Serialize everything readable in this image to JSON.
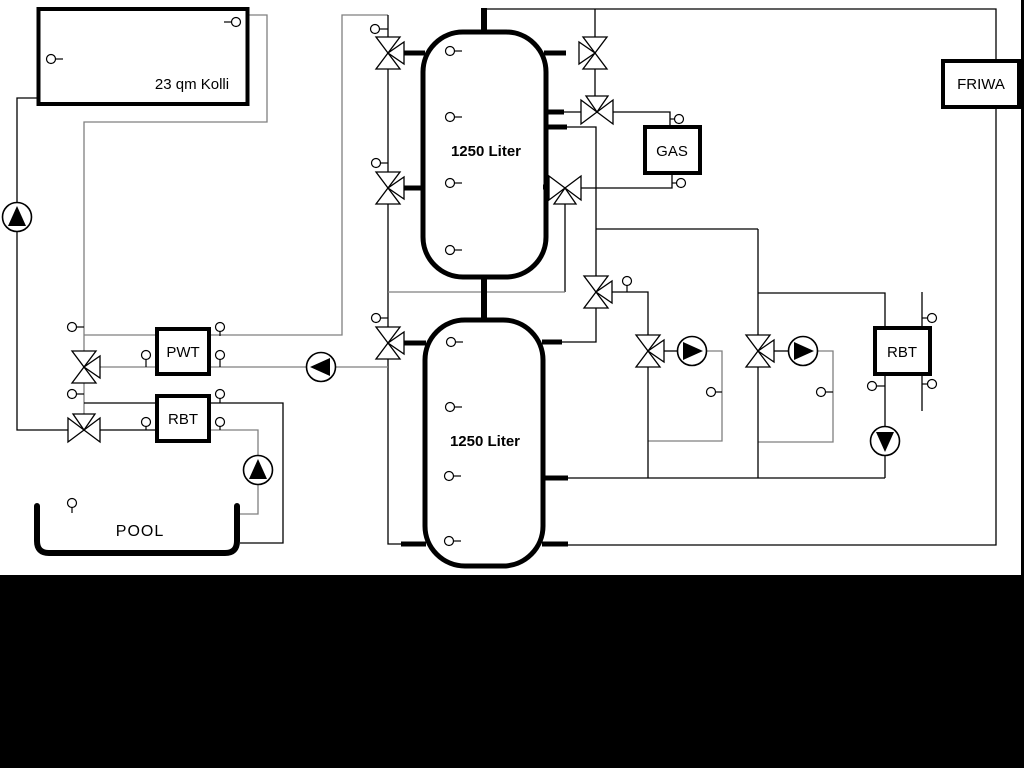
{
  "diagram": {
    "collector_label": "23 qm Kolli",
    "tank_top_label": "1250 Liter",
    "tank_bottom_label": "1250 Liter",
    "heat_exchanger_label": "PWT",
    "pool_return_unit_label": "RBT",
    "pool_label": "POOL",
    "boiler_label": "GAS",
    "heating_return_unit_label": "RBT",
    "fresh_water_label": "FRIWA"
  },
  "colors": {
    "pipe_black": "#000000",
    "pipe_gray": "#7f7f7f",
    "background": "#ffffff",
    "mask": "#000000"
  }
}
